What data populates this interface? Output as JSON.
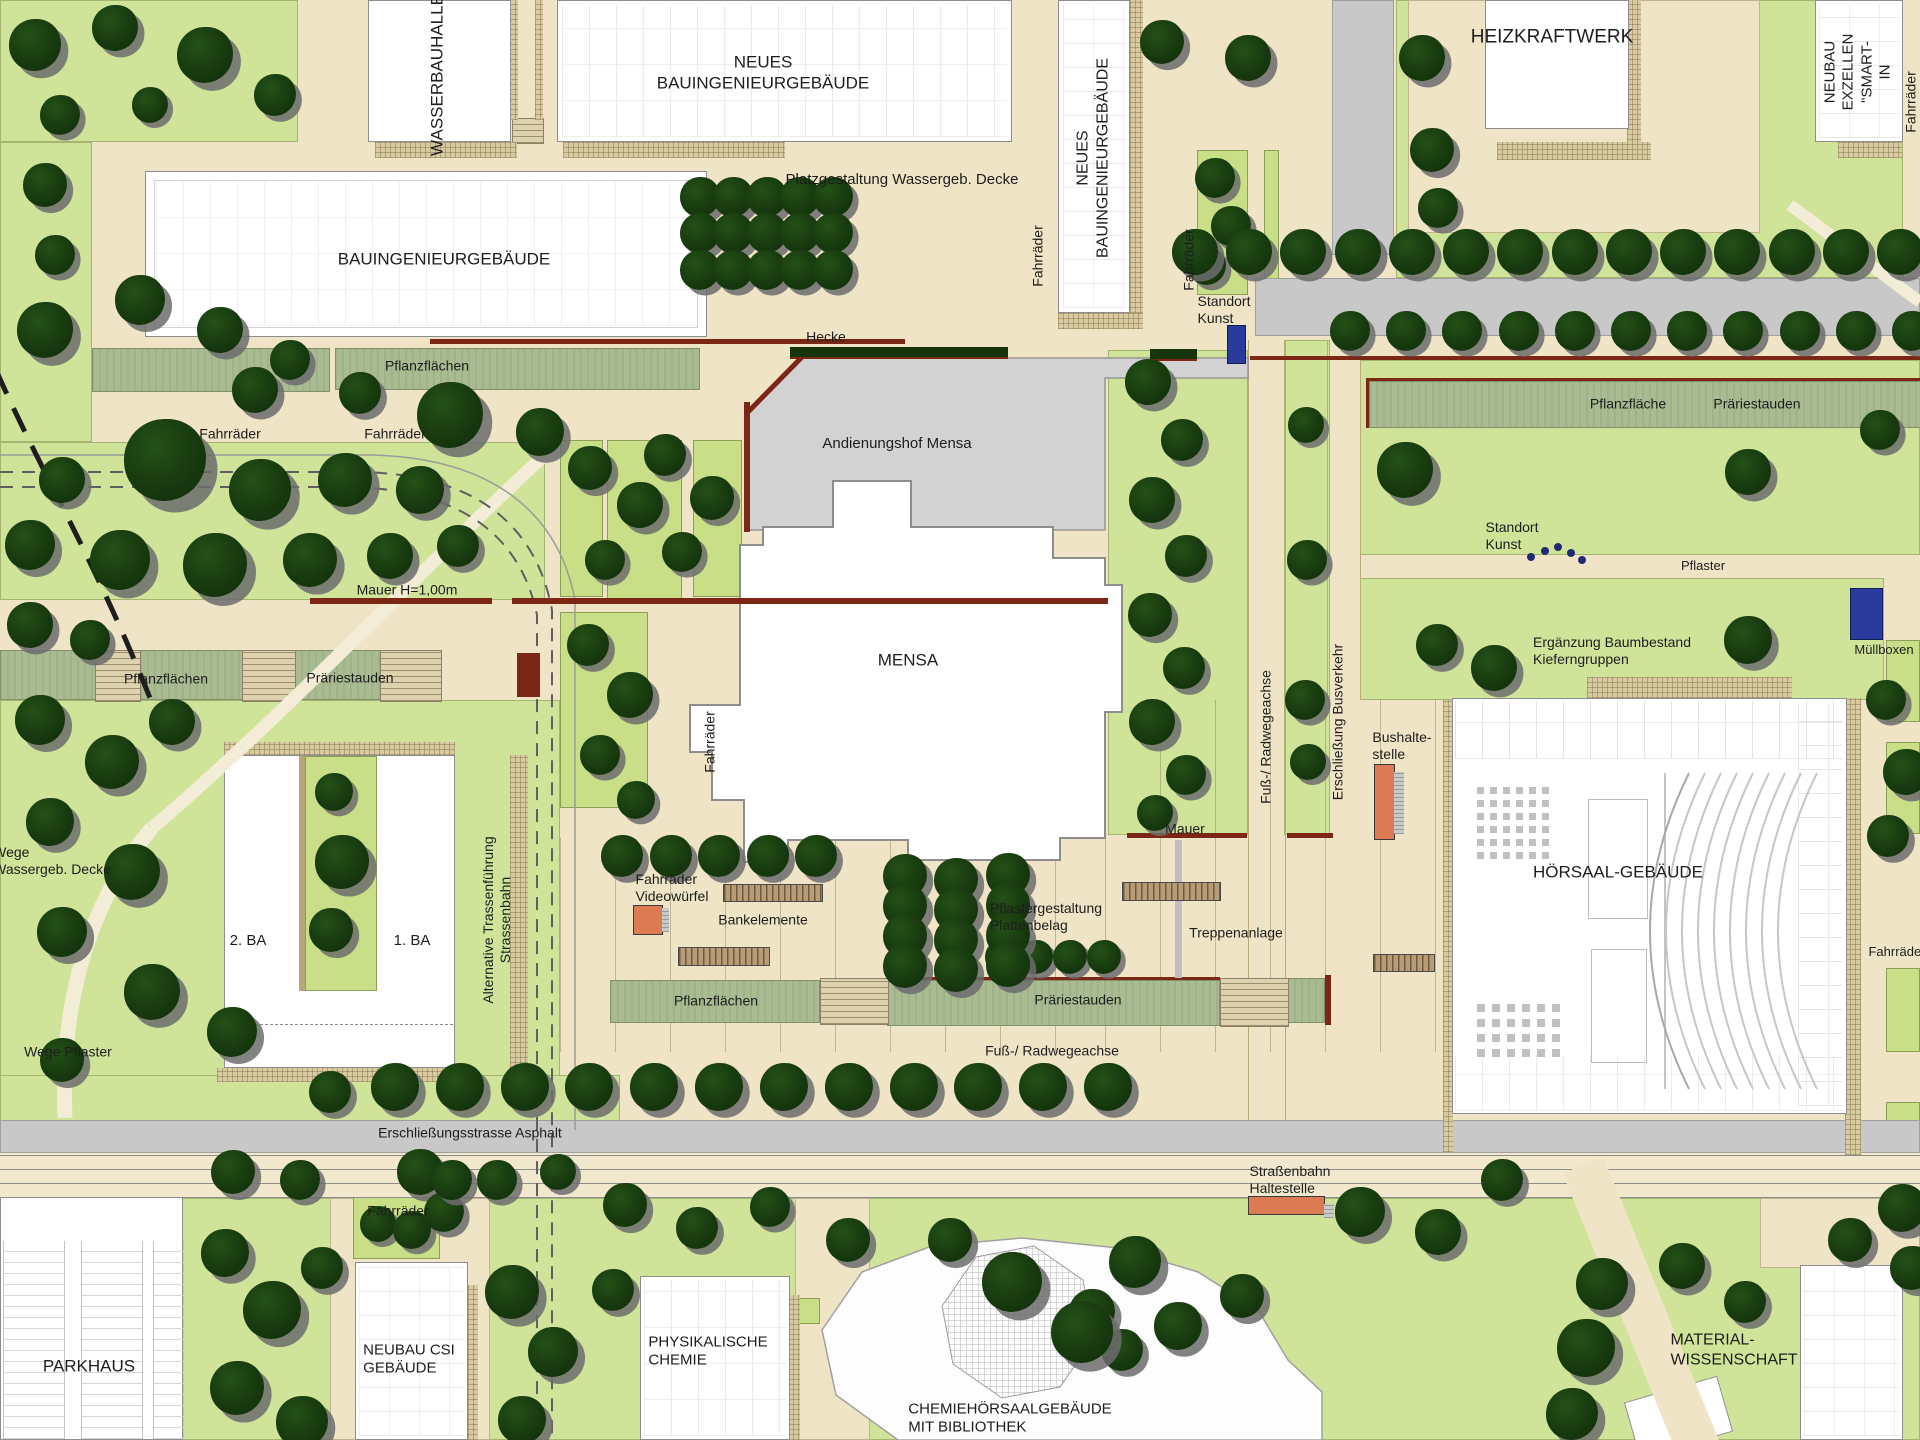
{
  "colors": {
    "lawn": "#cfe399",
    "planting_pad": "#c8df87",
    "path_beige": "#efe4c5",
    "sage_planting": "#a9bc91",
    "road_gray": "#c8c8c8",
    "service_yard": "#d2d2d2",
    "building_white": "#ffffff",
    "tree_green": "#173a0f",
    "tree_shadow": "#6c6c6c",
    "wall_red": "#7c2616",
    "hedge_green": "#16350c",
    "art_marker_blue": "#2a3b9d",
    "stop_marker_orange": "#dc7a54",
    "bench_tan": "#b79c78",
    "label_text": "#1d1d1d"
  },
  "labels": [
    {
      "id": "wasserbauhalle",
      "text": "WASSERBAUHALLE",
      "x": 438,
      "y": 75,
      "rot": -90,
      "fs": 17
    },
    {
      "id": "neues-bauingenieurgebaeude-top",
      "text": "NEUES\nBAUINGENIEURGEBÄUDE",
      "x": 763,
      "y": 73,
      "fs": 17
    },
    {
      "id": "platzgestaltung-wassergeb-decke",
      "text": "Platzgestaltung Wassergeb. Decke",
      "x": 902,
      "y": 180,
      "fs": 15
    },
    {
      "id": "bauingenieurgebaeude",
      "text": "BAUINGENIEURGEBÄUDE",
      "x": 444,
      "y": 260,
      "fs": 17
    },
    {
      "id": "pflanzflaechen-west",
      "text": "Pflanzflächen",
      "x": 427,
      "y": 366,
      "fs": 14
    },
    {
      "id": "fahrraeder-nw-1",
      "text": "Fahrräder",
      "x": 230,
      "y": 434,
      "fs": 14
    },
    {
      "id": "fahrraeder-nw-2",
      "text": "Fahrräder",
      "x": 395,
      "y": 434,
      "fs": 14
    },
    {
      "id": "fahrraeder-platz",
      "text": "Fahrräder",
      "x": 1038,
      "y": 256,
      "rot": -90,
      "fs": 14
    },
    {
      "id": "neues-bauingenieurgebaeude-vert",
      "text": "NEUES\nBAUINGENIEURGEBÄUDE",
      "x": 1093,
      "y": 158,
      "rot": -90,
      "fs": 16
    },
    {
      "id": "fahrraeder-kunst",
      "text": "Fahrräder",
      "x": 1189,
      "y": 260,
      "rot": -90,
      "fs": 14
    },
    {
      "id": "standort-kunst-1",
      "text": "Standort\nKunst",
      "x": 1224,
      "y": 310,
      "fs": 14,
      "align": "left"
    },
    {
      "id": "heizkraftwerk",
      "text": "HEIZKRAFTWERK",
      "x": 1552,
      "y": 37,
      "fs": 19
    },
    {
      "id": "neubau-exzellenz",
      "text": "NEUBAU\nEXZELLEN\n\"SMART-IN",
      "x": 1858,
      "y": 72,
      "rot": -90,
      "fs": 15
    },
    {
      "id": "fahrraeder-ne",
      "text": "Fahrräder",
      "x": 1911,
      "y": 102,
      "rot": -90,
      "fs": 14
    },
    {
      "id": "hecke",
      "text": "Hecke",
      "x": 826,
      "y": 337,
      "fs": 14
    },
    {
      "id": "andienungshof-mensa",
      "text": "Andienungshof Mensa",
      "x": 897,
      "y": 444,
      "fs": 15
    },
    {
      "id": "mauer-h100",
      "text": "Mauer H=1,00m",
      "x": 407,
      "y": 590,
      "fs": 14
    },
    {
      "id": "pflanzflaeche-ost",
      "text": "Pflanzfläche",
      "x": 1628,
      "y": 404,
      "fs": 14
    },
    {
      "id": "praeriestauden-ost",
      "text": "Präriestauden",
      "x": 1757,
      "y": 404,
      "fs": 14
    },
    {
      "id": "mensa",
      "text": "MENSA",
      "x": 908,
      "y": 661,
      "fs": 17
    },
    {
      "id": "fahrraeder-mensa",
      "text": "Fahrräder",
      "x": 710,
      "y": 742,
      "rot": -90,
      "fs": 14
    },
    {
      "id": "pflanzflaechen-mitte",
      "text": "Pflanzflächen",
      "x": 166,
      "y": 679,
      "fs": 14
    },
    {
      "id": "praeriestauden-mitte",
      "text": "Präriestauden",
      "x": 350,
      "y": 678,
      "fs": 14
    },
    {
      "id": "standort-kunst-2",
      "text": "Standort\nKunst",
      "x": 1512,
      "y": 536,
      "fs": 14,
      "align": "left"
    },
    {
      "id": "pflaster",
      "text": "Pflaster",
      "x": 1703,
      "y": 566,
      "fs": 13
    },
    {
      "id": "muellboxen",
      "text": "Müllboxen",
      "x": 1884,
      "y": 650,
      "fs": 13
    },
    {
      "id": "ergaenzung-baumbestand",
      "text": "Ergänzung Baumbestand\nKieferngruppen",
      "x": 1612,
      "y": 651,
      "fs": 14,
      "align": "left"
    },
    {
      "id": "fuss-radwegeachse-vert",
      "text": "Fuß-/ Radwegeachse",
      "x": 1266,
      "y": 737,
      "rot": -90,
      "fs": 14
    },
    {
      "id": "erschliessung-busverkehr",
      "text": "Erschließung Busverkehr",
      "x": 1338,
      "y": 722,
      "rot": -90,
      "fs": 14
    },
    {
      "id": "bushaltestelle",
      "text": "Bushalte-\nstelle",
      "x": 1402,
      "y": 746,
      "fs": 14,
      "align": "left"
    },
    {
      "id": "hoersaal-gebaeude",
      "text": "HÖRSAAL-GEBÄUDE",
      "x": 1618,
      "y": 873,
      "fs": 17
    },
    {
      "id": "wege-wassergeb-decke",
      "text": "Wege\nWassergeb. Decke",
      "x": 52,
      "y": 861,
      "fs": 14,
      "align": "left"
    },
    {
      "id": "ba-2",
      "text": "2. BA",
      "x": 248,
      "y": 941,
      "fs": 15
    },
    {
      "id": "ba-1",
      "text": "1. BA",
      "x": 412,
      "y": 941,
      "fs": 15
    },
    {
      "id": "alternative-trasse",
      "text": "Alternative Trassenführung\nStrassenbahn",
      "x": 497,
      "y": 920,
      "rot": -90,
      "fs": 14
    },
    {
      "id": "fahrraeder-videowuerfel",
      "text": "Fahrräder\nVideowürfel",
      "x": 672,
      "y": 888,
      "fs": 14,
      "align": "left"
    },
    {
      "id": "bankelemente",
      "text": "Bankelemente",
      "x": 763,
      "y": 920,
      "fs": 14
    },
    {
      "id": "pflastergestaltung",
      "text": "Pflastergestaltung\nPlattenbelag",
      "x": 1046,
      "y": 917,
      "fs": 14,
      "align": "left"
    },
    {
      "id": "treppenanlage",
      "text": "Treppenanlage",
      "x": 1236,
      "y": 933,
      "fs": 14
    },
    {
      "id": "pflanzflaechen-sued",
      "text": "Pflanzflächen",
      "x": 716,
      "y": 1001,
      "fs": 14
    },
    {
      "id": "praeriestauden-sued",
      "text": "Präriestauden",
      "x": 1078,
      "y": 1000,
      "fs": 14
    },
    {
      "id": "mauer-treppe",
      "text": "Mauer",
      "x": 1185,
      "y": 829,
      "fs": 14
    },
    {
      "id": "fuss-radwegeachse-h",
      "text": "Fuß-/ Radwegeachse",
      "x": 1052,
      "y": 1051,
      "fs": 14
    },
    {
      "id": "wege-pflaster",
      "text": "Wege Pflaster",
      "x": 68,
      "y": 1052,
      "fs": 14
    },
    {
      "id": "erschliessungsstrasse-asphalt",
      "text": "Erschließungsstrasse Asphalt",
      "x": 470,
      "y": 1133,
      "fs": 14
    },
    {
      "id": "strassenbahn-haltestelle",
      "text": "Straßenbahn\nHaltestelle",
      "x": 1290,
      "y": 1180,
      "fs": 14,
      "align": "left"
    },
    {
      "id": "fahrraeder-csi",
      "text": "Fahrräder",
      "x": 398,
      "y": 1211,
      "fs": 14
    },
    {
      "id": "parkhaus",
      "text": "PARKHAUS",
      "x": 89,
      "y": 1367,
      "fs": 17
    },
    {
      "id": "neubau-csi-gebaeude",
      "text": "NEUBAU CSI\nGEBÄUDE",
      "x": 409,
      "y": 1360,
      "fs": 15,
      "align": "left"
    },
    {
      "id": "physikalische-chemie",
      "text": "PHYSIKALISCHE\nCHEMIE",
      "x": 708,
      "y": 1352,
      "fs": 15,
      "align": "left"
    },
    {
      "id": "chemiehoersaalgebaeude",
      "text": "CHEMIEHÖRSAALGEBÄUDE\nMIT BIBLIOTHEK",
      "x": 1010,
      "y": 1419,
      "fs": 15,
      "align": "left"
    },
    {
      "id": "material-wissenschaft",
      "text": "MATERIAL-\nWISSENSCHAFT",
      "x": 1734,
      "y": 1350,
      "fs": 16,
      "align": "left"
    },
    {
      "id": "fahrraeder-hoersaal-ost",
      "text": "Fahrräder",
      "x": 1897,
      "y": 952,
      "fs": 13
    }
  ],
  "map": {
    "trees": {
      "rows": [
        [
          1195,
          252,
          1900,
          252,
          14,
          46
        ],
        [
          1350,
          331,
          1912,
          331,
          11,
          40
        ],
        [
          395,
          1087,
          1108,
          1087,
          12,
          48
        ],
        [
          1002,
          957,
          1104,
          957,
          4,
          34
        ],
        [
          622,
          856,
          816,
          856,
          5,
          42
        ],
        [
          700,
          197,
          833,
          197,
          5,
          40
        ],
        [
          700,
          233,
          833,
          233,
          5,
          40
        ],
        [
          700,
          270,
          833,
          270,
          5,
          40
        ],
        [
          905,
          876,
          905,
          966,
          4,
          44
        ],
        [
          956,
          880,
          956,
          970,
          4,
          44
        ],
        [
          1008,
          875,
          1008,
          965,
          4,
          44
        ]
      ],
      "singles": [
        [
          35,
          45,
          52
        ],
        [
          115,
          28,
          46
        ],
        [
          205,
          55,
          56
        ],
        [
          275,
          95,
          42
        ],
        [
          60,
          115,
          40
        ],
        [
          150,
          105,
          36
        ],
        [
          45,
          185,
          44
        ],
        [
          55,
          255,
          40
        ],
        [
          140,
          300,
          50
        ],
        [
          45,
          330,
          56
        ],
        [
          220,
          330,
          46
        ],
        [
          290,
          360,
          40
        ],
        [
          360,
          393,
          42
        ],
        [
          255,
          390,
          46
        ],
        [
          450,
          415,
          66
        ],
        [
          540,
          432,
          48
        ],
        [
          165,
          460,
          82
        ],
        [
          260,
          490,
          62
        ],
        [
          345,
          480,
          54
        ],
        [
          420,
          490,
          48
        ],
        [
          62,
          480,
          46
        ],
        [
          30,
          545,
          50
        ],
        [
          120,
          560,
          60
        ],
        [
          215,
          565,
          64
        ],
        [
          310,
          560,
          54
        ],
        [
          390,
          556,
          46
        ],
        [
          458,
          546,
          42
        ],
        [
          30,
          625,
          46
        ],
        [
          90,
          640,
          40
        ],
        [
          40,
          720,
          50
        ],
        [
          112,
          762,
          54
        ],
        [
          50,
          822,
          48
        ],
        [
          132,
          872,
          56
        ],
        [
          62,
          932,
          50
        ],
        [
          152,
          992,
          56
        ],
        [
          232,
          1032,
          50
        ],
        [
          62,
          1060,
          44
        ],
        [
          172,
          722,
          46
        ],
        [
          334,
          792,
          38
        ],
        [
          342,
          862,
          54
        ],
        [
          331,
          930,
          44
        ],
        [
          330,
          1092,
          42
        ],
        [
          590,
          468,
          44
        ],
        [
          640,
          505,
          46
        ],
        [
          605,
          560,
          40
        ],
        [
          665,
          455,
          42
        ],
        [
          712,
          498,
          44
        ],
        [
          682,
          552,
          40
        ],
        [
          588,
          645,
          42
        ],
        [
          630,
          695,
          46
        ],
        [
          600,
          755,
          40
        ],
        [
          636,
          800,
          38
        ],
        [
          1148,
          382,
          46
        ],
        [
          1182,
          440,
          42
        ],
        [
          1152,
          500,
          46
        ],
        [
          1186,
          556,
          42
        ],
        [
          1150,
          615,
          44
        ],
        [
          1184,
          668,
          42
        ],
        [
          1152,
          722,
          46
        ],
        [
          1186,
          775,
          40
        ],
        [
          1155,
          813,
          36
        ],
        [
          1306,
          425,
          36
        ],
        [
          1307,
          560,
          40
        ],
        [
          1305,
          700,
          40
        ],
        [
          1308,
          762,
          36
        ],
        [
          1215,
          178,
          40
        ],
        [
          1231,
          226,
          40
        ],
        [
          1207,
          266,
          38
        ],
        [
          1162,
          42,
          44
        ],
        [
          1248,
          58,
          46
        ],
        [
          1422,
          58,
          46
        ],
        [
          1432,
          150,
          44
        ],
        [
          1438,
          208,
          40
        ],
        [
          1405,
          470,
          56
        ],
        [
          1748,
          472,
          46
        ],
        [
          1880,
          430,
          40
        ],
        [
          1437,
          645,
          42
        ],
        [
          1494,
          668,
          46
        ],
        [
          1748,
          640,
          48
        ],
        [
          1886,
          700,
          40
        ],
        [
          1906,
          772,
          46
        ],
        [
          1888,
          836,
          42
        ],
        [
          1902,
          1208,
          48
        ],
        [
          1912,
          1268,
          44
        ],
        [
          233,
          1172,
          44
        ],
        [
          300,
          1180,
          40
        ],
        [
          420,
          1172,
          46
        ],
        [
          497,
          1180,
          40
        ],
        [
          558,
          1172,
          36
        ],
        [
          625,
          1205,
          44
        ],
        [
          697,
          1228,
          42
        ],
        [
          770,
          1207,
          40
        ],
        [
          225,
          1253,
          48
        ],
        [
          272,
          1310,
          58
        ],
        [
          237,
          1388,
          54
        ],
        [
          302,
          1422,
          52
        ],
        [
          322,
          1268,
          42
        ],
        [
          378,
          1224,
          36
        ],
        [
          412,
          1230,
          38
        ],
        [
          444,
          1212,
          40
        ],
        [
          452,
          1180,
          40
        ],
        [
          512,
          1292,
          54
        ],
        [
          553,
          1352,
          50
        ],
        [
          522,
          1420,
          48
        ],
        [
          613,
          1290,
          42
        ],
        [
          848,
          1240,
          44
        ],
        [
          1092,
          1312,
          46
        ],
        [
          1122,
          1350,
          42
        ],
        [
          1178,
          1326,
          48
        ],
        [
          1242,
          1296,
          44
        ],
        [
          1012,
          1282,
          60
        ],
        [
          1082,
          1332,
          62
        ],
        [
          1135,
          1262,
          52
        ],
        [
          950,
          1240,
          44
        ],
        [
          1360,
          1212,
          50
        ],
        [
          1438,
          1232,
          46
        ],
        [
          1602,
          1284,
          52
        ],
        [
          1586,
          1348,
          58
        ],
        [
          1572,
          1414,
          52
        ],
        [
          1682,
          1266,
          46
        ],
        [
          1745,
          1302,
          42
        ],
        [
          1850,
          1240,
          44
        ],
        [
          1502,
          1180,
          42
        ]
      ]
    },
    "markers": {
      "art_locations": 2,
      "art_dot_count": 5,
      "bus_stop": "Bushaltestelle",
      "tram_stop": "Straßenbahn Haltestelle",
      "waste": "Müllboxen",
      "video_cube": "Videowürfel"
    }
  }
}
